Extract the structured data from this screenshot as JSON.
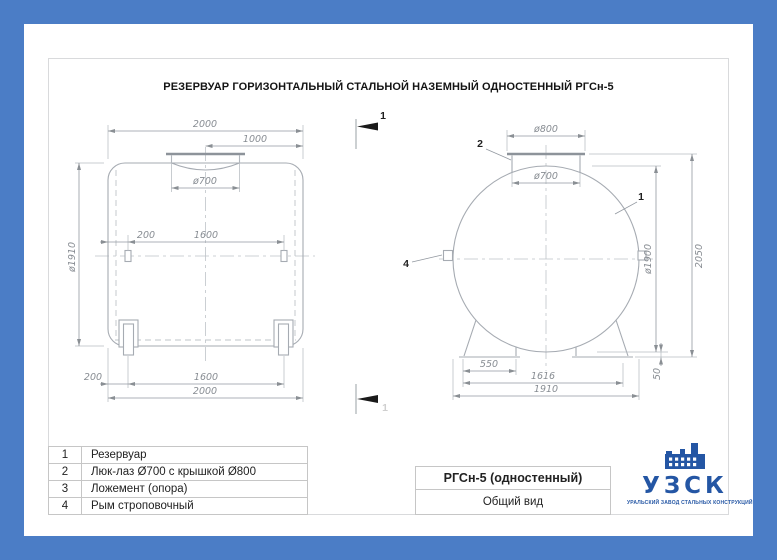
{
  "page_title": "РЕЗЕРВУАР ГОРИЗОНТАЛЬНЫЙ СТАЛЬНОЙ НАЗЕМНЫЙ ОДНОСТЕННЫЙ РГСн-5",
  "side_view": {
    "dims": {
      "length_top": "2000",
      "half": "1000",
      "manhole": "ø700",
      "eye_offset": "200",
      "eye_span": "1600",
      "diameter": "ø1910",
      "support_offset": "200",
      "support_span": "1600",
      "length_bottom": "2000"
    }
  },
  "end_view": {
    "dims": {
      "cover": "ø800",
      "neck": "ø700",
      "diameter": "ø1900",
      "height": "2050",
      "saddle": "550",
      "saddle_span": "1616",
      "base": "1910",
      "clearance": "50"
    },
    "callouts": {
      "tank": "1",
      "hatch": "2",
      "eye": "4"
    }
  },
  "section_marks": {
    "top": "1",
    "bottom": "1"
  },
  "parts_table": {
    "rows": [
      {
        "num": "1",
        "name": "Резервуар"
      },
      {
        "num": "2",
        "name": "Люк-лаз Ø700 с крышкой Ø800"
      },
      {
        "num": "3",
        "name": "Ложемент (опора)"
      },
      {
        "num": "4",
        "name": "Рым строповочный"
      }
    ]
  },
  "title_block": {
    "model": "РГСн-5 (одностенный)",
    "view_name": "Общий вид"
  },
  "logo": {
    "abbr": "УЗСК",
    "tagline": "УРАЛЬСКИЙ ЗАВОД СТАЛЬНЫХ КОНСТРУКЦИЙ"
  },
  "colors": {
    "frame_blue": "#4b7dc6",
    "logo_blue": "#2456a4",
    "outline_gray": "#a6abb2",
    "dim_text_gray": "#888d93"
  }
}
